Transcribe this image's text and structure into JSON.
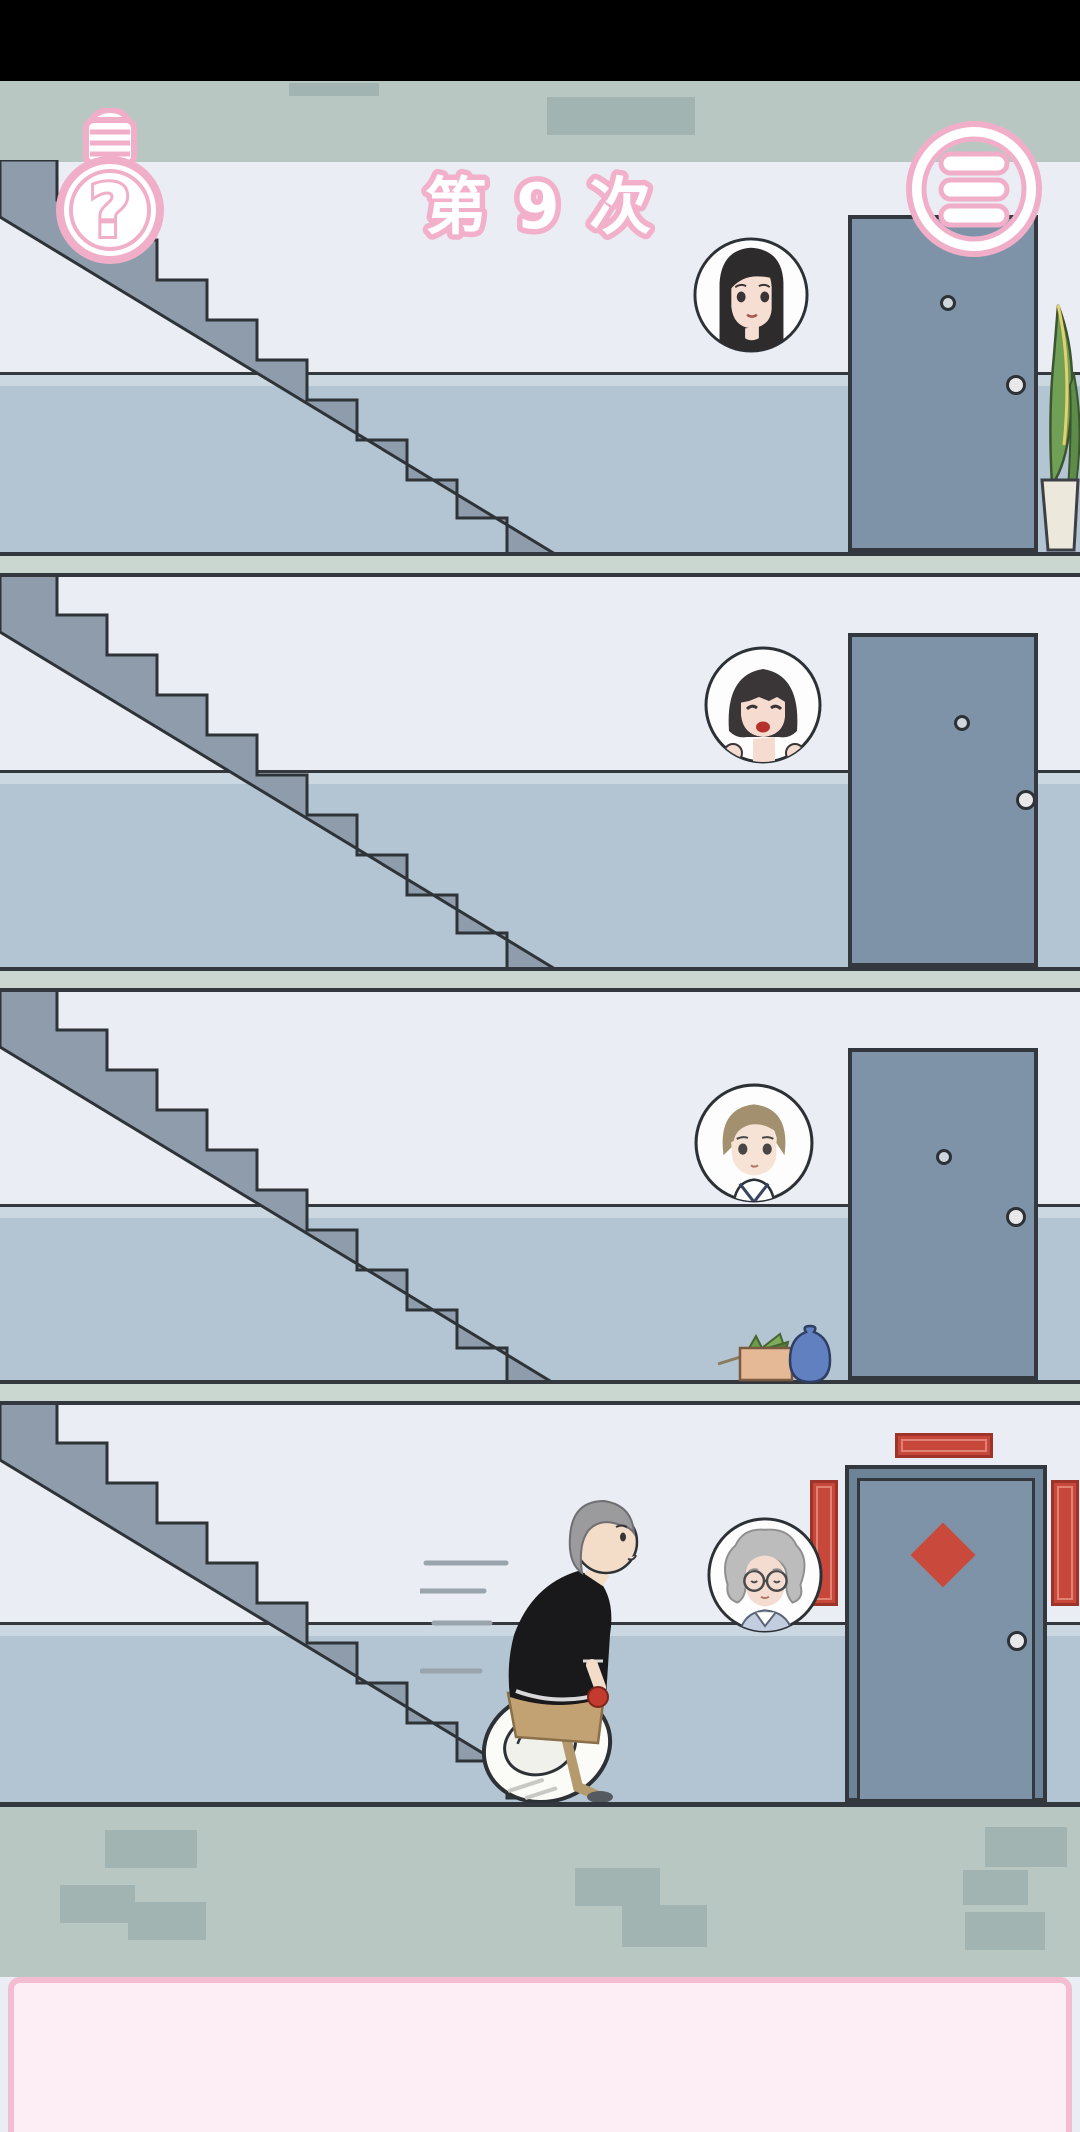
{
  "app": {
    "name": "apartment-stairs-game",
    "scene": "stairwell with four floors"
  },
  "hud": {
    "hint_button": {
      "icon": "lightbulb-question-icon",
      "glyph": "?"
    },
    "attempt_counter": {
      "text": "第 9 次"
    },
    "menu_button": {
      "icon": "hamburger-menu-icon"
    }
  },
  "colors": {
    "accent-pink": "#f0aec8",
    "pink-panel": "#fdedf4",
    "pink-border": "#f3bcd1",
    "wall-upper": "#eaedf3",
    "parapet": "#b3c4d3",
    "parapet-strip": "#cbd8e1",
    "slab": "#cad6d0",
    "band": "#b9c7c3",
    "brick": "#a2b4b2",
    "stair": "#8e9cab",
    "line": "#33383e",
    "door": "#7e93a8",
    "door-frame": "#6d8398",
    "red-banner": "#c7473a",
    "red-banner-dark": "#9e332a",
    "red-banner-light": "#e08274"
  },
  "floors": [
    {
      "id": 1,
      "resident": "young-woman-long-black-hair",
      "door": {
        "style": "plain",
        "peephole": true,
        "knob": true
      },
      "extras": [
        "potted-plant"
      ]
    },
    {
      "id": 2,
      "resident": "girl-bob-hair",
      "door": {
        "style": "plain",
        "peephole": true,
        "knob": true
      },
      "extras": []
    },
    {
      "id": 3,
      "resident": "boy-short-brown-hair",
      "door": {
        "style": "plain",
        "peephole": true,
        "knob": true
      },
      "extras": [
        "cardboard-box-with-greens",
        "blue-vase"
      ]
    },
    {
      "id": 4,
      "resident": "grandma-glasses",
      "door": {
        "style": "decorated",
        "decorations": [
          "red-top-banner",
          "red-left-banner",
          "red-right-banner",
          "red-diamond"
        ],
        "knob": true
      },
      "extras": [
        "player-character"
      ]
    }
  ],
  "player": {
    "description": "gray-haired man rushing downstairs carrying a toilet seat",
    "held_item": "red-apple"
  }
}
